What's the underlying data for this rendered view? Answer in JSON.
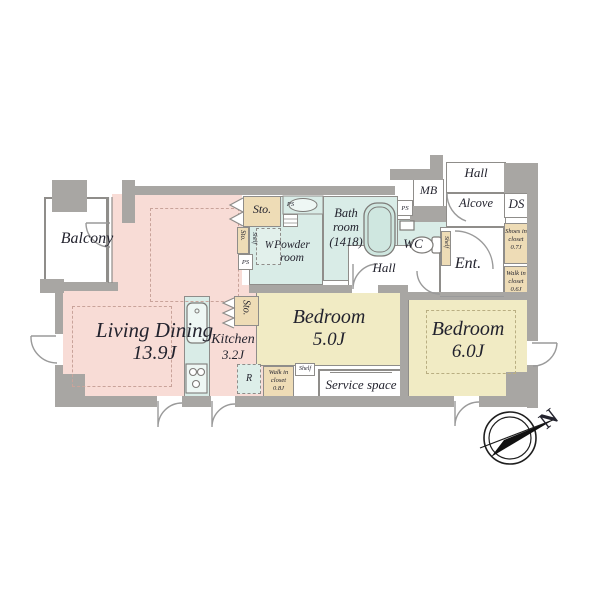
{
  "floorplan": {
    "compass_north": "N",
    "rooms": {
      "balcony": "Balcony",
      "living_dining": {
        "name": "Living Dining",
        "area": "13.9J"
      },
      "kitchen": {
        "name": "Kitchen",
        "area": "3.2J"
      },
      "bedroom_5": {
        "name": "Bedroom",
        "area": "5.0J"
      },
      "bedroom_6": {
        "name": "Bedroom",
        "area": "6.0J"
      },
      "bath": {
        "line1": "Bath",
        "line2": "room",
        "line3": "(1418)"
      },
      "powder": {
        "line1": "Powder",
        "line2": "room"
      },
      "wc": "WC",
      "mb": "MB",
      "ds": "DS",
      "alcove": "Alcove",
      "entrance": "Ent.",
      "hall_top": "Hall",
      "hall_mid": "Hall",
      "service_space": "Service space",
      "shoes_closet": {
        "line1": "Shoes in",
        "line2": "closet",
        "line3": "0.7J"
      },
      "walk_in_closet_06": {
        "line1": "Walk in",
        "line2": "closet",
        "line3": "0.6J"
      },
      "walk_in_closet_08": {
        "line1": "Walk in",
        "line2": "closet",
        "line3": "0.8J"
      }
    },
    "fixtures": {
      "storage": "Sto.",
      "pipe_space": "PS",
      "washer": "W",
      "fridge": "R",
      "shelf": "Shelf"
    },
    "colors": {
      "room_pink": "#f8dcd6",
      "room_yellow": "#f1ebc4",
      "room_cyan": "#d9ece7",
      "closet_beige": "#eedcb6",
      "wall_gray": "#a8a6a3"
    }
  }
}
